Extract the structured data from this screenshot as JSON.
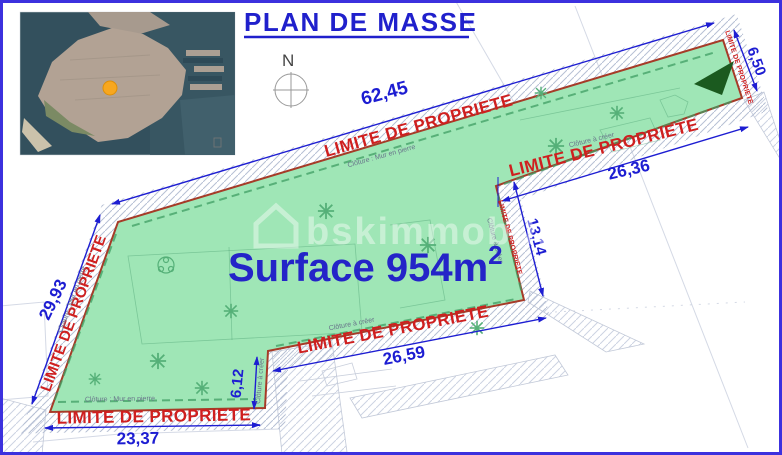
{
  "title": "PLAN DE MASSE",
  "compass": {
    "north": "N"
  },
  "surface": {
    "text": "Surface 954m",
    "sup": "2"
  },
  "watermark": {
    "text": "bskimmobilier"
  },
  "labels": {
    "limite": "LIMITE DE PROPRIETE",
    "fence_stone": "Clôture : Mur en pierre",
    "fence_create": "Clôture à créer"
  },
  "dims": {
    "top": "62,45",
    "top_right": "6,50",
    "right": "26,36",
    "inner_right": "13,14",
    "bottom_middle": "26,59",
    "step": "6,12",
    "bottom_left": "23,37",
    "left": "29,93"
  },
  "colors": {
    "frame_blue": "#3c31de",
    "accent_blue": "#1d1dd2",
    "label_red": "#cf1f1f",
    "boundary_red": "#a63b28",
    "parcel_green": "#9fe6b6",
    "triangle_green": "#1b5a1f",
    "marker_orange": "#f7a71f"
  }
}
